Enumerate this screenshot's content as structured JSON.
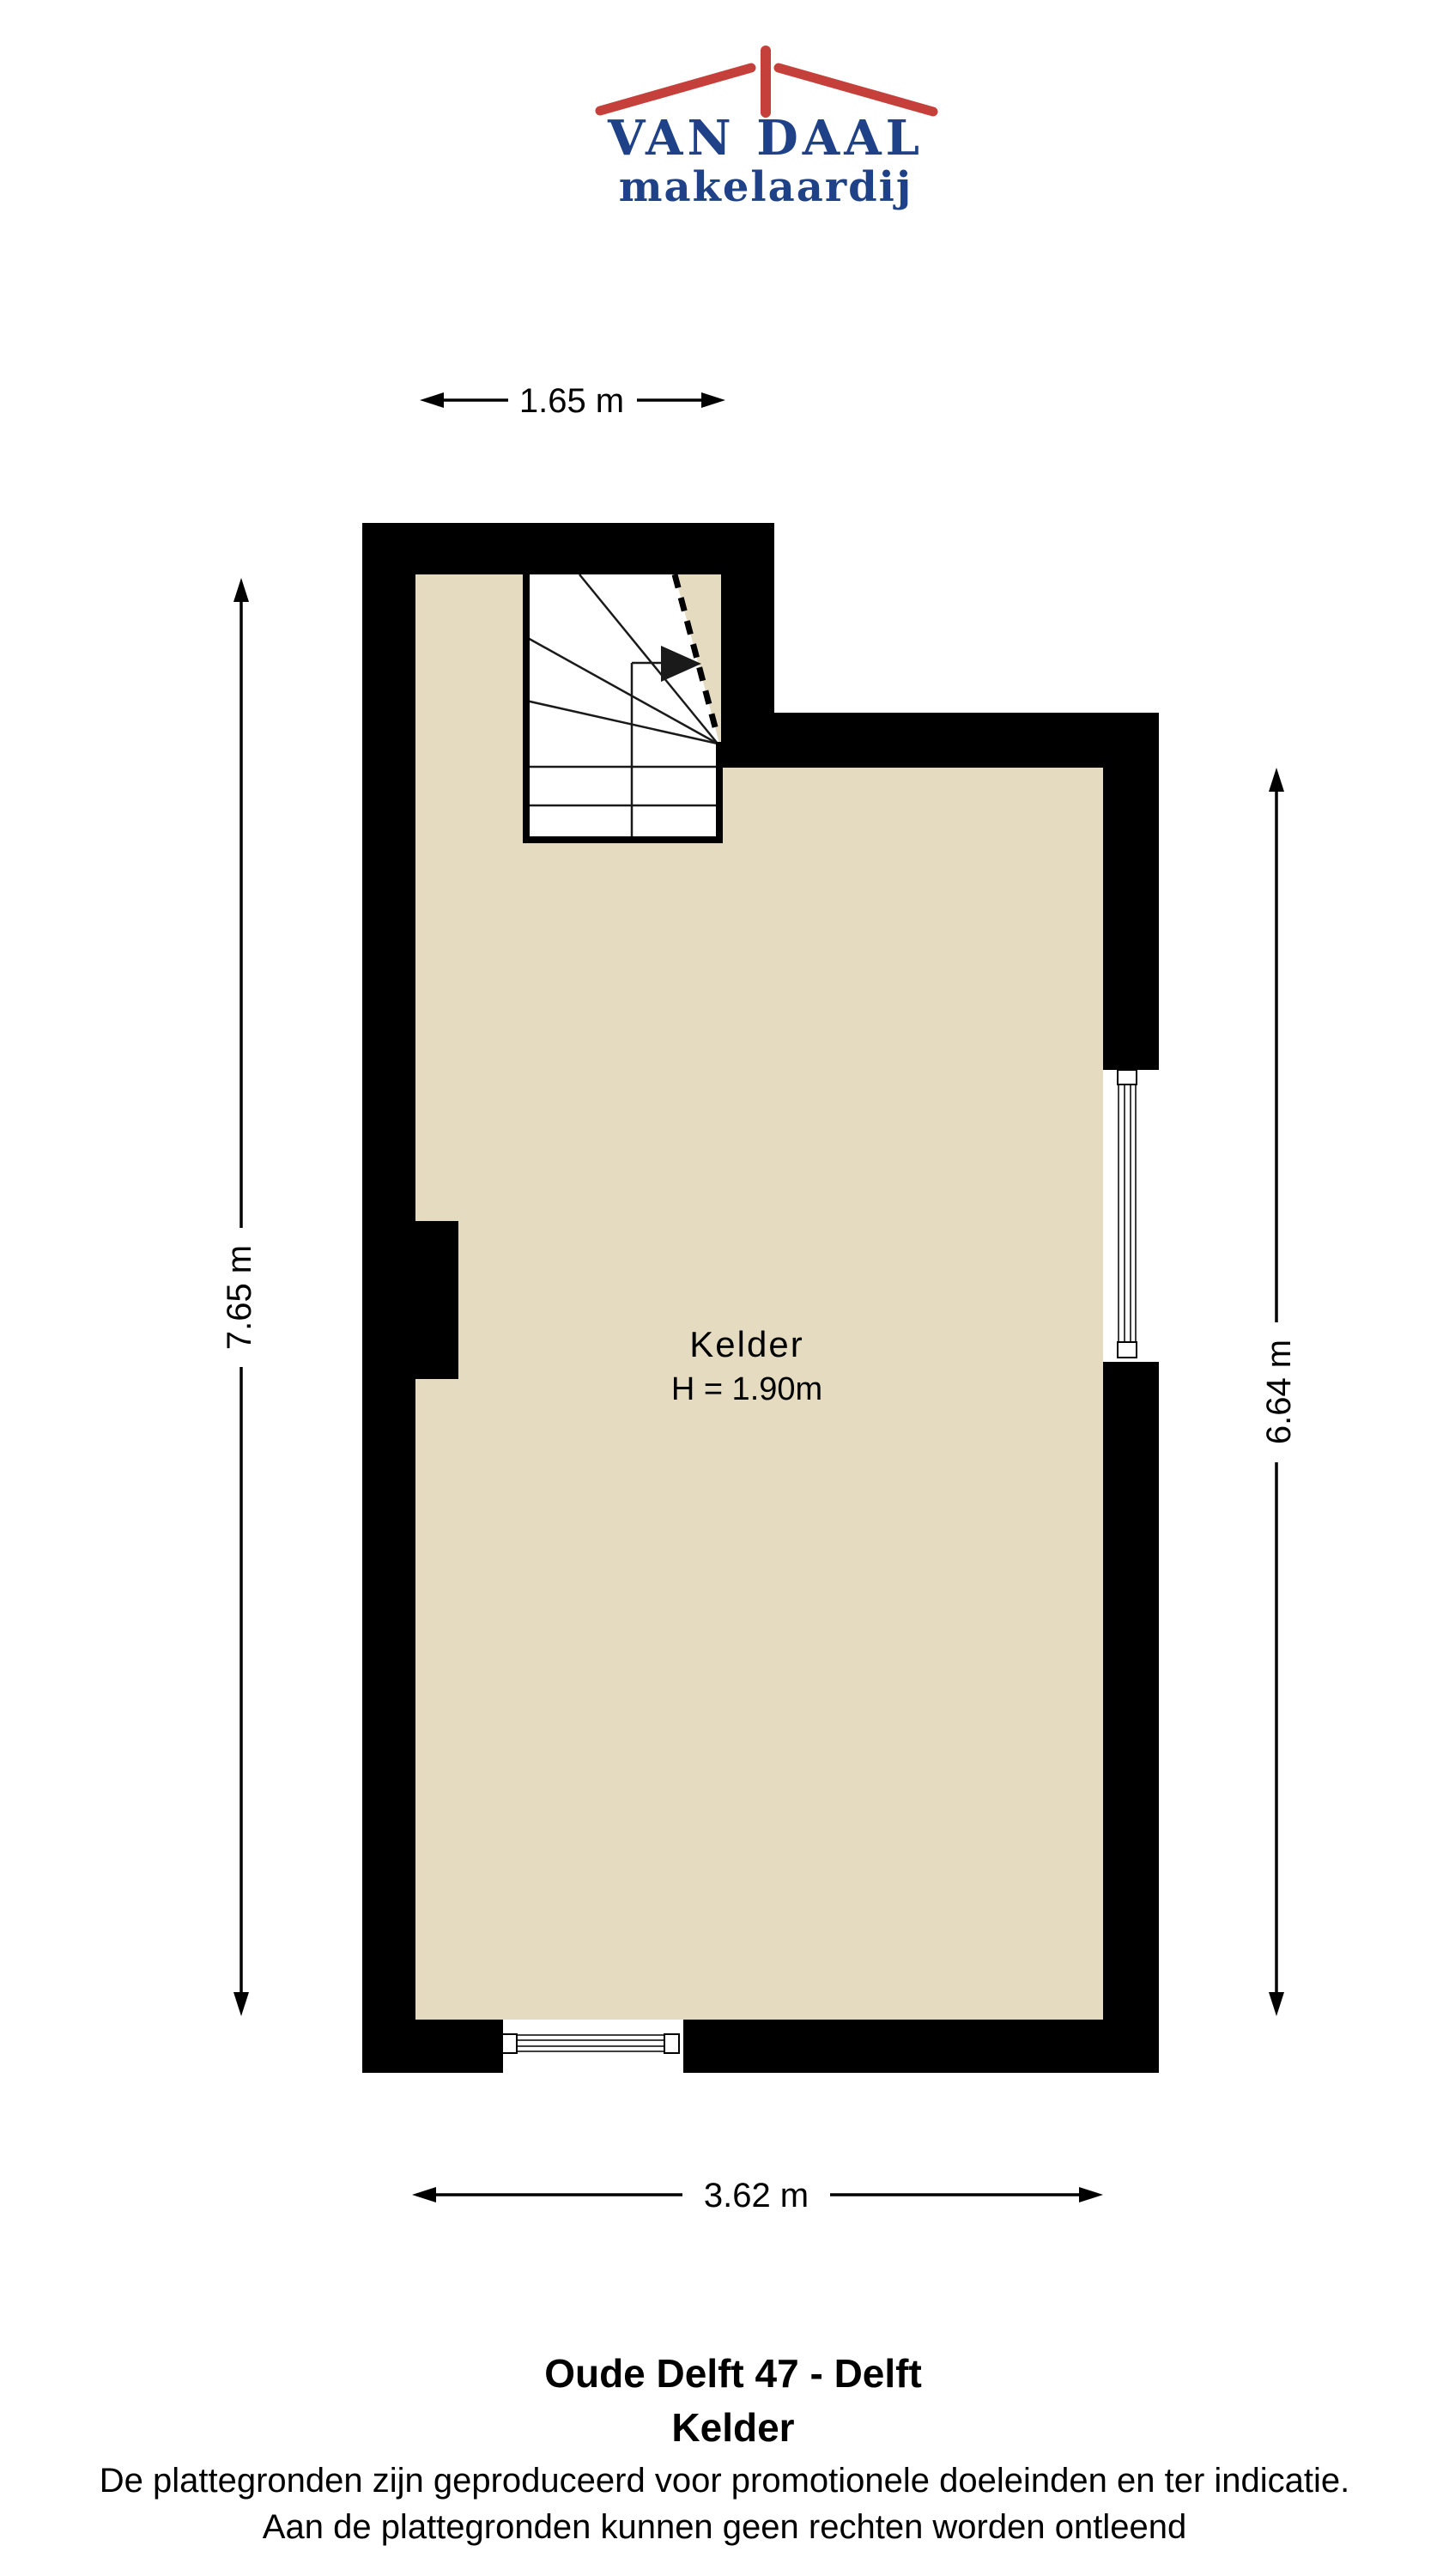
{
  "logo": {
    "brand_top": "VAN DAAL",
    "brand_bottom": "makelaardij"
  },
  "plan": {
    "room_label": "Kelder",
    "room_height": "H = 1.90m",
    "dim_top": "1.65 m",
    "dim_left": "7.65 m",
    "dim_right": "6.64 m",
    "dim_bottom": "3.62 m",
    "icons": {
      "logo_roof": "roof-with-chimney",
      "stairs_arrow": "right-direction-arrow"
    },
    "colors": {
      "wall": "#000000",
      "floor": "#e5dbc0",
      "stairs_fill": "#ffffff",
      "logo_red": "#c5403a",
      "logo_navy": "#1f4187"
    }
  },
  "footer": {
    "title": "Oude Delft 47 - Delft",
    "subtitle": "Kelder",
    "disclaimer_line1": "De plattegronden zijn geproduceerd voor promotionele doeleinden en ter indicatie.",
    "disclaimer_line2": "Aan de plattegronden kunnen geen rechten worden ontleend"
  }
}
